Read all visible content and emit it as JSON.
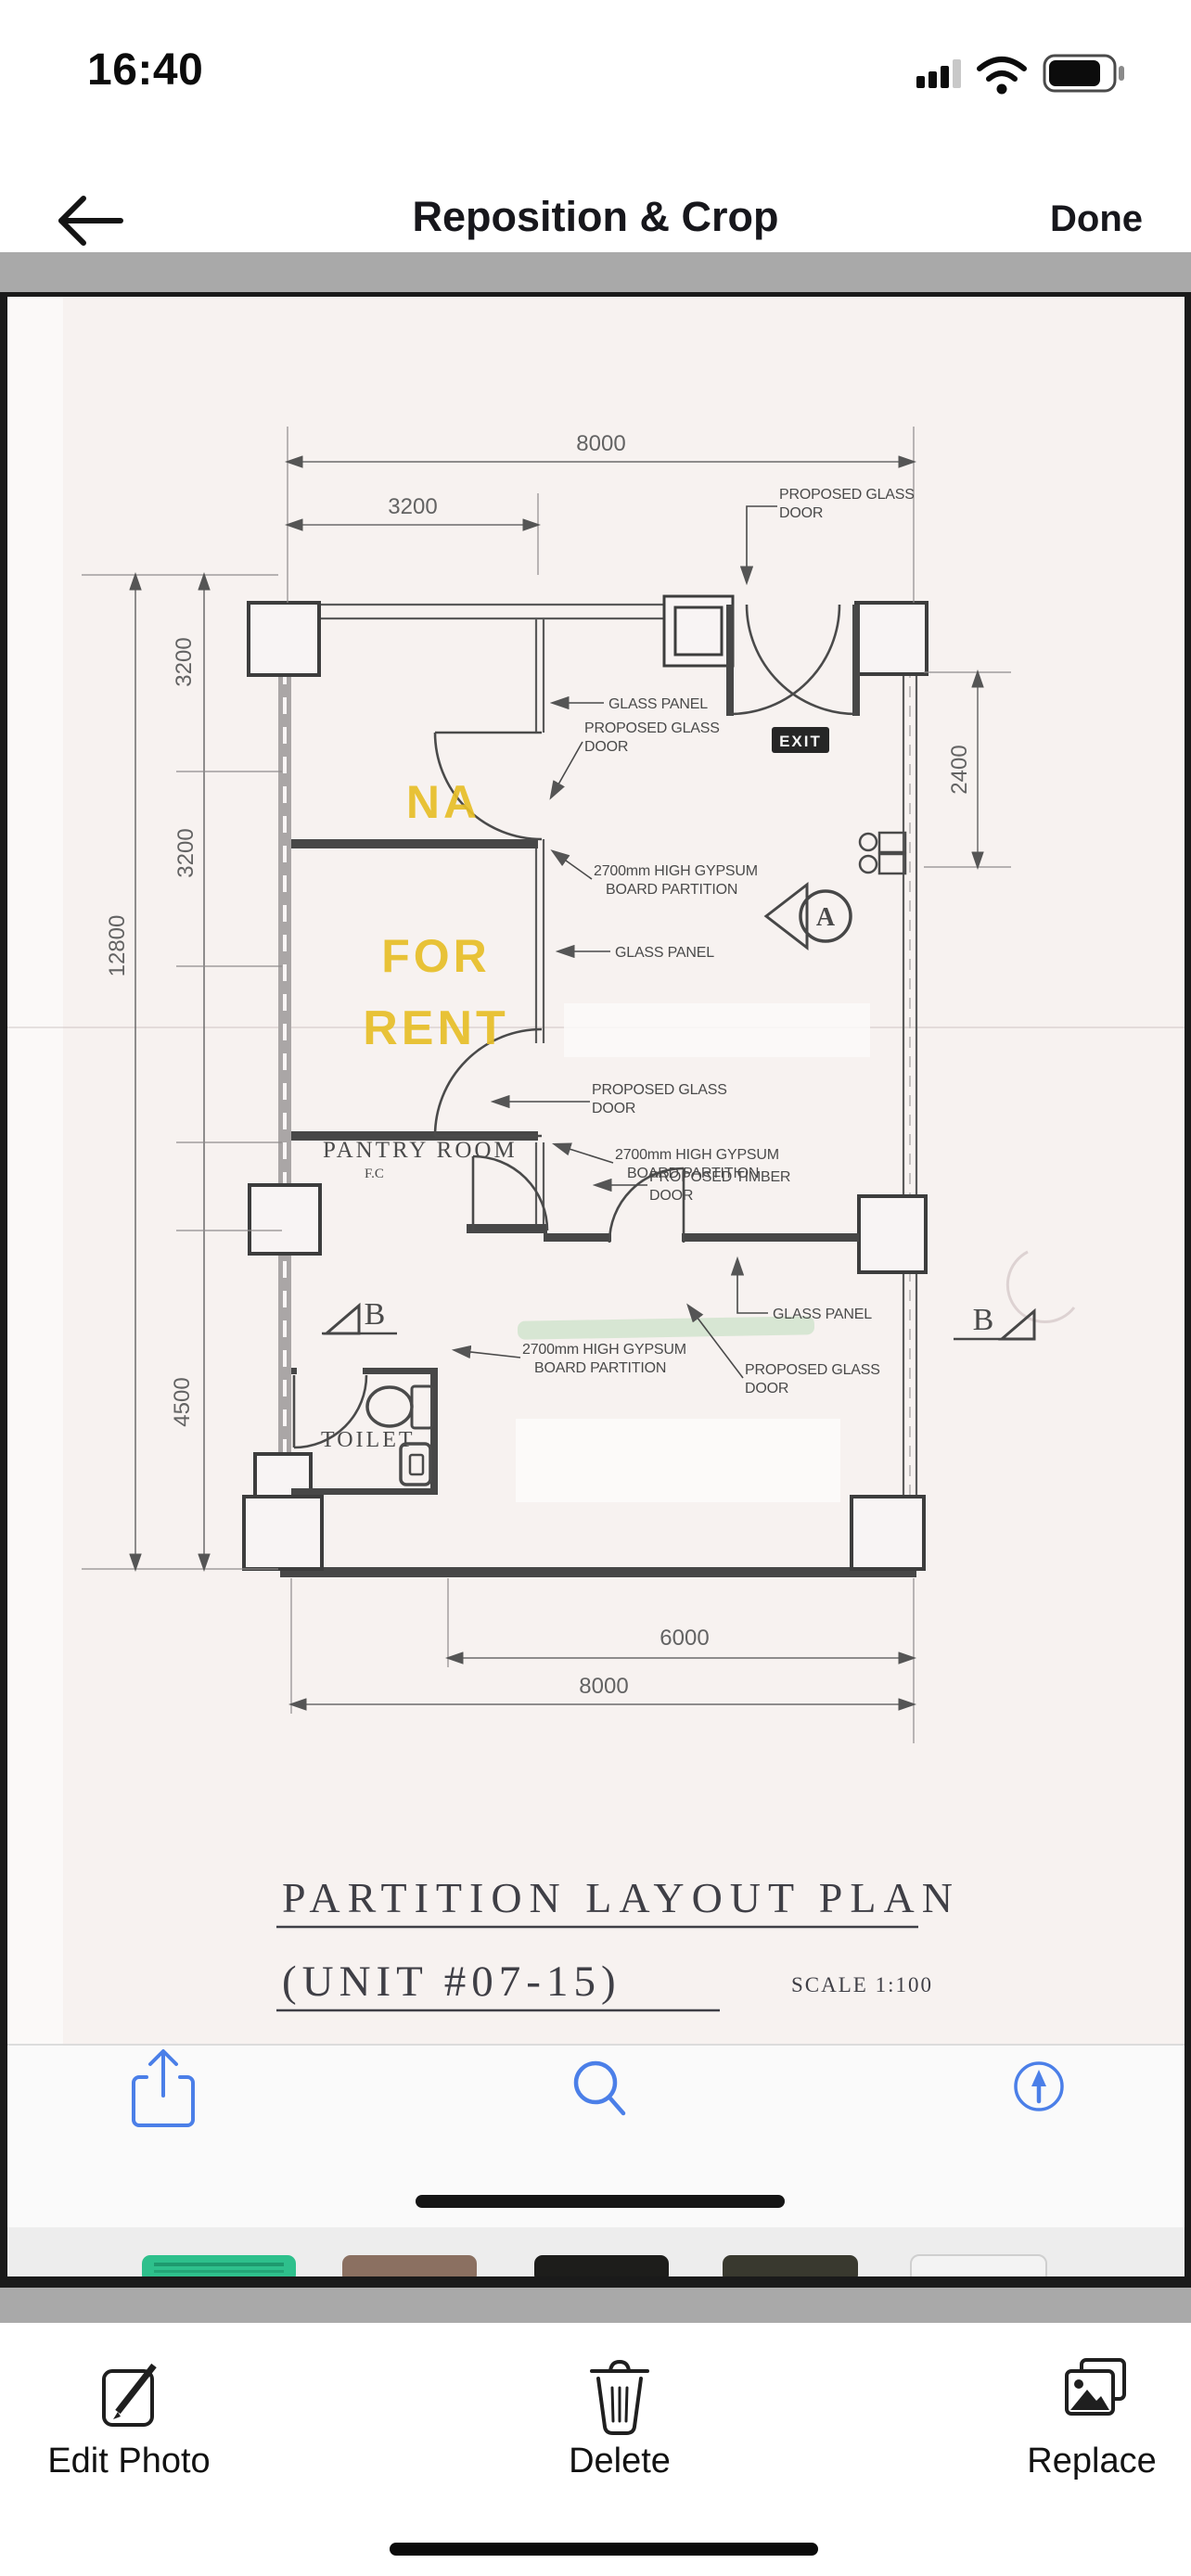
{
  "status_bar": {
    "time": "16:40"
  },
  "nav_bar": {
    "title": "Reposition & Crop",
    "done_label": "Done"
  },
  "plan": {
    "title": {
      "line1": "PARTITION LAYOUT PLAN",
      "line2": "(UNIT #07-15)",
      "scale": "SCALE 1:100"
    },
    "rooms": {
      "na": "NA",
      "for_rent_line1": "FOR",
      "for_rent_line2": "RENT",
      "pantry": "PANTRY ROOM",
      "pantry_sub": "F.C",
      "toilet": "TOILET",
      "exit": "EXIT"
    },
    "annotations": {
      "proposed_glass_door": [
        "PROPOSED GLASS",
        "DOOR"
      ],
      "glass_panel": "GLASS PANEL",
      "gypsum": [
        "2700mm HIGH GYPSUM",
        "BOARD PARTITION"
      ],
      "timber_door": [
        "PROPOSED TIMBER",
        "DOOR"
      ]
    },
    "dimensions": {
      "top_overall": "8000",
      "top_left": "3200",
      "right": "2400",
      "left_overall": "12800",
      "left_seg1": "3200",
      "left_seg2": "3200",
      "left_seg3": "4500",
      "bottom_inner": "6000",
      "bottom_overall": "8000"
    },
    "section_markers": {
      "a": "A",
      "b": "B"
    }
  },
  "bottom_toolbar": {
    "edit": "Edit Photo",
    "delete": "Delete",
    "replace": "Replace"
  },
  "colors": {
    "accent_blue": "#4b7fe8",
    "highlight_yellow": "#e7bf28",
    "gray_strip": "#a9a9a9",
    "paper": "#f7f2f0"
  }
}
